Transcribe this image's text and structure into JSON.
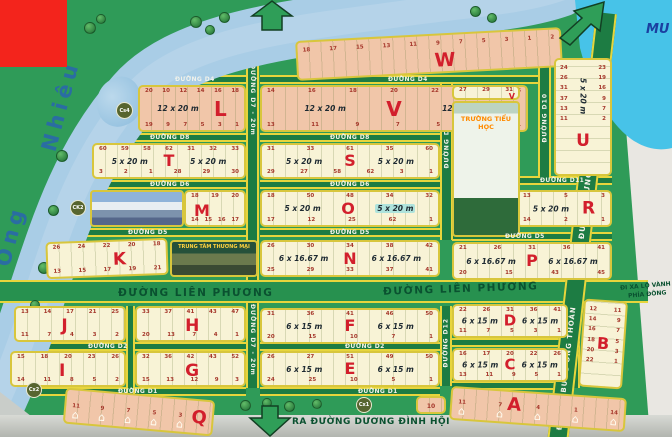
{
  "colors": {
    "land_green": "#2f9b58",
    "street_green": "#1d7c43",
    "border_yellow": "#e7d53c",
    "block_cream": "#f8f3d6",
    "block_pink": "#f1c6a9",
    "river_blue": "#a9cde6",
    "canal_cyan": "#47c3e8",
    "letter_red": "#d21f2c",
    "dark_green_text": "#0a5130",
    "redaction_red": "#f3241c"
  },
  "watermark": "MU",
  "river": {
    "label": "Sông Ông Nhiêu",
    "w1": "Sông",
    "w2": "Ông",
    "w3": "Nhiêu"
  },
  "streets": {
    "d1": "ĐƯỜNG D1",
    "d2": "ĐƯỜNG D2",
    "d4": "ĐƯỜNG D4",
    "d5": "ĐƯỜNG D5",
    "d6": "ĐƯỜNG D6",
    "d7": "ĐƯỜNG D7 - 20m",
    "d8": "ĐƯỜNG D8",
    "d9": "ĐƯỜNG D9",
    "d10": "ĐƯỜNG D10",
    "d11": "ĐƯỜNG D11",
    "d12": "ĐƯỜNG D12",
    "d13": "ĐƯỜNG D13",
    "lien_phuong": "ĐƯỜNG LIÊN PHƯƠNG",
    "bung_ong_thoan": "ĐƯỜNG BƯNG ÔNG THOÀN"
  },
  "exits": {
    "south": "RA ĐƯỜNG DƯƠNG ĐÌNH HỘI",
    "east_line1": "ĐI XA LỘ VÀNH ĐAI",
    "east_line2": "PHÍA ĐÔNG"
  },
  "markers": {
    "cs4": "Cs4",
    "ck2": "CK2",
    "cx2": "Cx2",
    "cx1": "Cx1"
  },
  "pois": {
    "school": "TRƯỜNG TIỂU HỌC",
    "mall": "TRUNG TÂM THƯƠNG MẠI"
  },
  "dims": {
    "d12x20": "12 x 20 m",
    "d5x20": "5 x 20 m",
    "d6x1667": "6 x 16.67 m",
    "d6x15": "6 x 15 m"
  },
  "blocks": {
    "W": {
      "letter": "W",
      "nums": "18 17 15 13 11 9 7 5 3 1 2"
    },
    "L": {
      "letter": "L",
      "top": "20 10 12 14 16 18",
      "bottom": "19 9 7 5 3 1"
    },
    "V": {
      "letter": "V",
      "top": "14 16 18 20 22 24 26",
      "bottom": "13 11 9 7 5 3 1"
    },
    "V2": {
      "letter": "V",
      "nums": "27 29 31"
    },
    "U": {
      "letter": "U",
      "left": "24\n26\n31\n37\n13\n11",
      "right": "23\n19\n16\n9\n7\n2"
    },
    "T": {
      "letter": "T",
      "top": "60 59 58 62 31 32 33",
      "bottom": "3 2 1 28 29 30"
    },
    "S": {
      "letter": "S",
      "top": "31 33 61 35 60",
      "bottom": "29 27 58 62 3 1"
    },
    "M": {
      "letter": "M",
      "top": "18 19 20",
      "bottom": "14 15 16 17"
    },
    "O": {
      "letter": "O",
      "top": "18 50 48 34 32",
      "bottom": "17 12 25 62 1"
    },
    "R": {
      "letter": "R",
      "top": "13 5 3",
      "bottom": "14 2 1"
    },
    "K": {
      "letter": "K",
      "top": "26 24 22 20 18",
      "bottom": "13 15 17 19 21"
    },
    "N": {
      "letter": "N",
      "top": "26 30 34 38 42",
      "bottom": "25 29 33 37 41"
    },
    "P": {
      "letter": "P",
      "top": "21 26 31 36 41",
      "bottom": "20 15 43 45"
    },
    "J": {
      "letter": "J",
      "top": "13 14 17 21 25",
      "bottom": "11 7 4 3 2"
    },
    "H": {
      "letter": "H",
      "top": "33 37 41 43 47",
      "bottom": "20 13 7 4 1"
    },
    "F": {
      "letter": "F",
      "top": "31 36 41 46 50",
      "bottom": "20 15 10 7 1"
    },
    "D": {
      "letter": "D",
      "top": "22 26 31 36 41",
      "bottom": "11 7 5 3 1"
    },
    "I": {
      "letter": "I",
      "top": "15 18 20 23 26",
      "bottom": "14 11 8 5 2"
    },
    "G": {
      "letter": "G",
      "top": "32 36 42 43 52",
      "bottom": "15 13 12 9 3"
    },
    "E": {
      "letter": "E",
      "top": "26 27 51 49 50",
      "bottom": "24 25 10 5 1"
    },
    "C": {
      "letter": "C",
      "top": "16 17 20 22 26",
      "bottom": "13 11 9 5 1"
    },
    "B": {
      "letter": "B",
      "left": "12\n14\n16\n18\n20\n22",
      "right": "11\n9\n7\n5\n3\n1"
    },
    "A": {
      "letter": "A",
      "n": [
        "11",
        "7",
        "4",
        "1",
        "14"
      ]
    },
    "Q": {
      "letter": "Q",
      "n": [
        "11",
        "9",
        "7",
        "5",
        "3"
      ]
    },
    "lot10": "10"
  }
}
